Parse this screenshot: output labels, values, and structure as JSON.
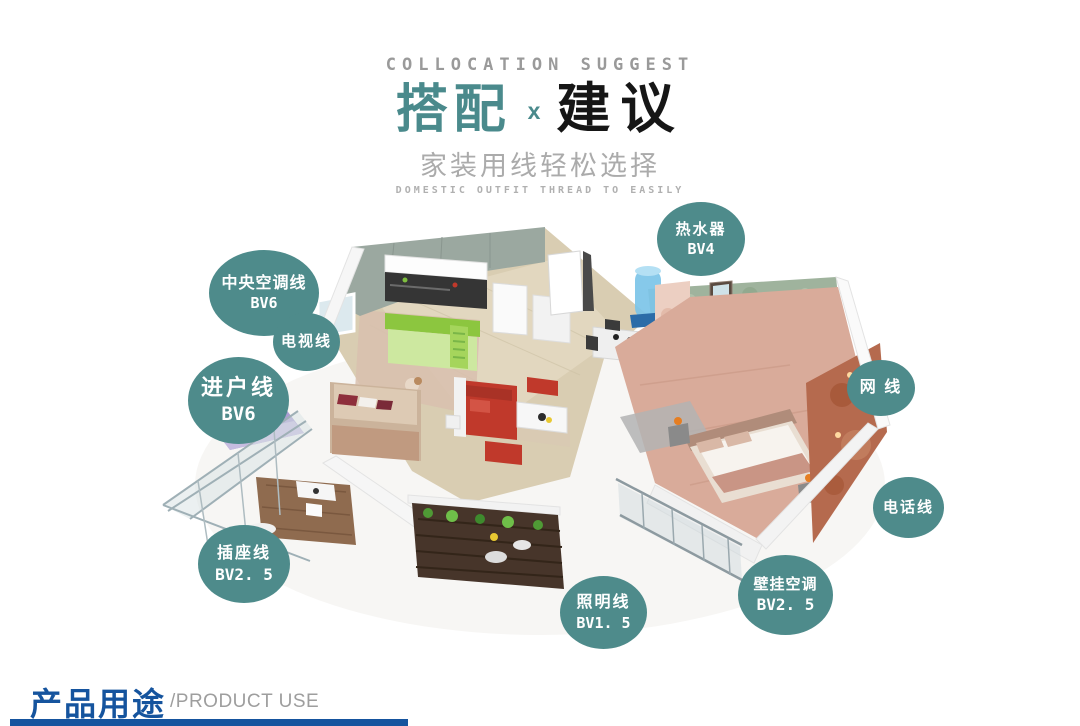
{
  "header": {
    "eyebrow": "COLLOCATION SUGGEST",
    "title_left": "搭配",
    "title_sep": "x",
    "title_right": "建议",
    "subtitle": "家装用线轻松选择",
    "subtitle_en": "DOMESTIC OUTFIT THREAD TO EASILY"
  },
  "bubbles": [
    {
      "key": "water-heater",
      "line1": "热水器",
      "line2": "BV4"
    },
    {
      "key": "central-ac",
      "line1": "中央空调线",
      "line2": "BV6"
    },
    {
      "key": "tv",
      "line1": "电视线",
      "line2": ""
    },
    {
      "key": "entry",
      "line1": "进户线",
      "line2": "BV6"
    },
    {
      "key": "network",
      "line1": "网 线",
      "line2": ""
    },
    {
      "key": "phone",
      "line1": "电话线",
      "line2": ""
    },
    {
      "key": "socket",
      "line1": "插座线",
      "line2": "BV2. 5"
    },
    {
      "key": "lighting",
      "line1": "照明线",
      "line2": "BV1. 5"
    },
    {
      "key": "wall-ac",
      "line1": "壁挂空调",
      "line2": "BV2. 5"
    }
  ],
  "footer": {
    "title": "产品用途",
    "subtitle": "/PRODUCT USE"
  },
  "colors": {
    "bubble_teal": "#4E8B8B",
    "title_teal": "#4A8A8C",
    "title_dark": "#161616",
    "eyebrow_gray": "#9A9A9A",
    "subtitle_gray": "#ABABAB",
    "footer_blue": "#15549E",
    "footer_gray": "#9E9E9E"
  }
}
